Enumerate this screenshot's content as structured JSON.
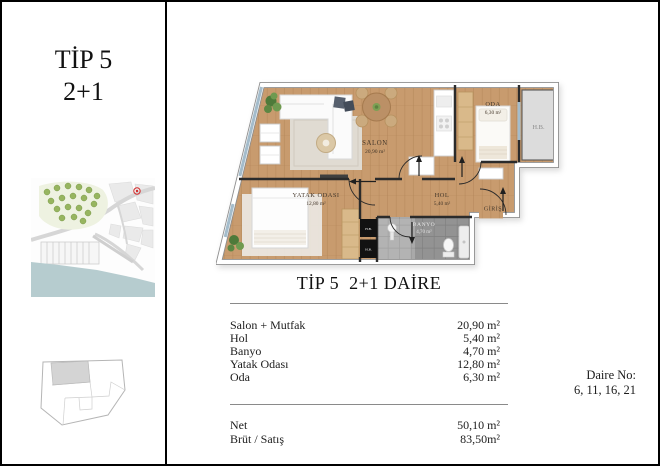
{
  "left_panel": {
    "title_line1": "TİP 5",
    "title_line2": "2+1"
  },
  "floor_plan": {
    "rooms": {
      "salon": {
        "name": "SALON",
        "area": "20,90 m²"
      },
      "yatak_odasi": {
        "name": "YATAK ODASI",
        "area": "12,80 m²"
      },
      "oda": {
        "name": "ODA",
        "area": "6,30 m²"
      },
      "hol": {
        "name": "HOL",
        "area": "5,40 m²"
      },
      "banyo": {
        "name": "BANYO",
        "area": "4,70 m²"
      }
    },
    "entrance_label": "GİRİŞ",
    "shaft_label": "H.B.",
    "shaft_small_label": "H.B."
  },
  "details": {
    "heading": "TİP 5  2+1 DAİRE",
    "area_rows": [
      {
        "label": "Salon + Mutfak",
        "value": "20,90 m²"
      },
      {
        "label": "Hol",
        "value": "5,40 m²"
      },
      {
        "label": "Banyo",
        "value": "4,70 m²"
      },
      {
        "label": "Yatak Odası",
        "value": "12,80 m²"
      },
      {
        "label": "Oda",
        "value": "6,30 m²"
      }
    ],
    "total_rows": [
      {
        "label": "Net",
        "value": "50,10 m²"
      },
      {
        "label": "Brüt / Satış",
        "value": "83,50m²"
      }
    ],
    "unit_no_label": "Daire No:",
    "unit_no_values": "6, 11, 16, 21"
  },
  "colors": {
    "floor_wood": "#c89b6e",
    "bath_tile": "#a9a9a9",
    "water": "#b6cccf",
    "park": "#97b560",
    "marker_red": "#d42b2b",
    "window": "#a4bccb"
  }
}
